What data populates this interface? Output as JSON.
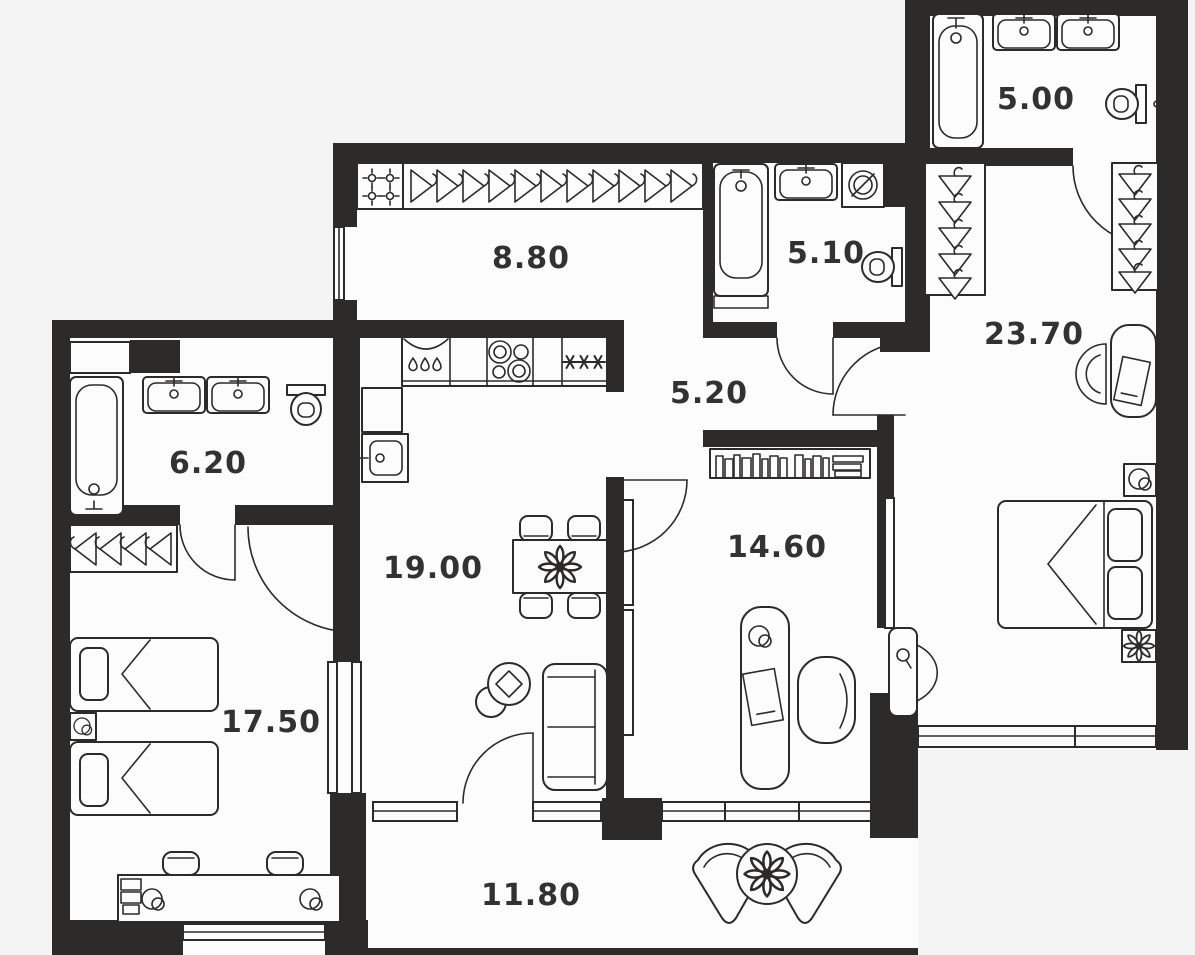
{
  "plan": {
    "title": "Apartment floor plan",
    "canvas": {
      "width": 1195,
      "height": 955
    },
    "colors": {
      "background": "#f4f4f5",
      "room_fill": "#fcfcfc",
      "wall": "#2d2b2a",
      "label": "#323232"
    },
    "rooms": [
      {
        "id": "entry-hall",
        "area": "8.80"
      },
      {
        "id": "bathroom-2",
        "area": "5.10"
      },
      {
        "id": "bathroom-master",
        "area": "5.00"
      },
      {
        "id": "bedroom-master",
        "area": "23.70"
      },
      {
        "id": "hallway",
        "area": "5.20"
      },
      {
        "id": "bathroom-1",
        "area": "6.20"
      },
      {
        "id": "kitchen-living-room",
        "area": "19.00"
      },
      {
        "id": "study",
        "area": "14.60"
      },
      {
        "id": "bedroom-2",
        "area": "17.50"
      },
      {
        "id": "balcony",
        "area": "11.80"
      }
    ],
    "icons": {
      "bathtub-icon": "rounded rectangle tub with faucet dot",
      "sink-icon": "rounded basin with tap",
      "toilet-icon": "bowl with cistern",
      "washing-machine-icon": "square with drum circle",
      "hanger-icon": "triangle clothes hanger",
      "stove-icon": "four burner circles",
      "freezer-icon": "three asterisks",
      "dishwasher-icon": "three drops",
      "bed-icon": "mattress with pillows and fold",
      "sofa-icon": "rectangle with back and cushions",
      "dining-table-icon": "table with four chairs and flower",
      "desk-icon": "rounded desk with laptop and lamp",
      "armchair-icon": "rounded chair",
      "bookshelf-icon": "row of book spines",
      "plant-icon": "flower rosette",
      "window": "double line in wall",
      "door-arc": "quarter-circle swing"
    }
  }
}
